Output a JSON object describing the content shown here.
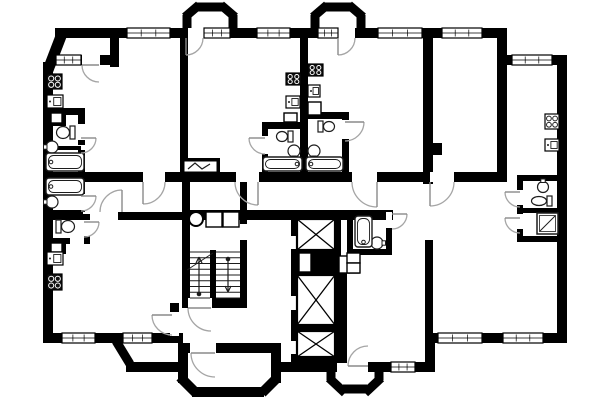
{
  "app": {
    "type": "architectural-floor-plan",
    "canvas_w": 600,
    "canvas_h": 400,
    "colors": {
      "wall": "#000000",
      "bg": "#ffffff",
      "fixture": "#1c1c1c",
      "arc": "#a5a5a5",
      "leaf": "#8a8a8a"
    }
  },
  "plan": {
    "chamfers": [
      [
        48,
        70,
        63,
        31,
        11,
        "corner-chamfer"
      ],
      [
        116,
        341,
        130,
        364,
        9,
        "porch-chamfer"
      ],
      [
        180,
        377,
        196,
        393,
        10,
        "bay-chamfer"
      ],
      [
        262,
        393,
        277,
        378,
        10,
        "bay-chamfer"
      ],
      [
        331,
        367,
        331,
        380,
        9,
        "bay-side"
      ],
      [
        329,
        378,
        345,
        393,
        9,
        "bay-chamfer"
      ],
      [
        343,
        389,
        367,
        389,
        9,
        "bay-bottom"
      ],
      [
        365,
        393,
        381,
        378,
        9,
        "bay-chamfer"
      ],
      [
        379,
        367,
        379,
        380,
        9,
        "bay-side"
      ],
      [
        187,
        30,
        187,
        15,
        9,
        "bay-side"
      ],
      [
        185,
        17,
        199,
        5,
        9,
        "bay-chamfer"
      ],
      [
        195,
        7,
        225,
        7,
        9,
        "bay-top"
      ],
      [
        221,
        5,
        235,
        17,
        9,
        "bay-chamfer"
      ],
      [
        233,
        15,
        233,
        30,
        9,
        "bay-side"
      ],
      [
        315,
        30,
        315,
        15,
        9,
        "bay-side"
      ],
      [
        313,
        17,
        327,
        5,
        9,
        "bay-chamfer"
      ],
      [
        323,
        7,
        353,
        7,
        9,
        "bay-top"
      ],
      [
        349,
        5,
        363,
        17,
        9,
        "bay-chamfer"
      ],
      [
        361,
        15,
        361,
        30,
        9,
        "bay-side"
      ]
    ],
    "walls": [
      [
        55,
        28,
        448,
        10
      ],
      [
        43,
        62,
        10,
        281
      ],
      [
        43,
        333,
        140,
        10
      ],
      [
        126,
        362,
        57,
        10
      ],
      [
        182,
        343,
        89,
        10
      ],
      [
        178,
        343,
        10,
        40
      ],
      [
        271,
        343,
        10,
        40
      ],
      [
        192,
        387,
        72,
        10
      ],
      [
        279,
        362,
        58,
        10
      ],
      [
        368,
        362,
        62,
        10
      ],
      [
        425,
        343,
        10,
        29
      ],
      [
        425,
        333,
        142,
        10
      ],
      [
        557,
        55,
        10,
        288
      ],
      [
        503,
        55,
        64,
        10
      ],
      [
        497,
        28,
        10,
        154
      ],
      [
        110,
        28,
        9,
        39
      ],
      [
        53,
        55,
        57,
        10
      ],
      [
        180,
        38,
        8,
        136
      ],
      [
        300,
        38,
        8,
        134
      ],
      [
        423,
        38,
        10,
        146
      ],
      [
        423,
        143,
        19,
        12
      ],
      [
        53,
        172,
        450,
        10
      ],
      [
        118,
        212,
        66,
        8
      ],
      [
        247,
        210,
        146,
        10
      ],
      [
        182,
        182,
        8,
        126
      ],
      [
        240,
        182,
        7,
        126
      ],
      [
        182,
        210,
        65,
        10
      ],
      [
        182,
        298,
        65,
        10
      ],
      [
        170,
        303,
        9,
        40
      ],
      [
        43,
        108,
        42,
        7
      ],
      [
        78,
        108,
        7,
        37
      ],
      [
        43,
        146,
        38,
        4
      ],
      [
        78,
        150,
        7,
        26
      ],
      [
        78,
        182,
        7,
        30
      ],
      [
        43,
        210,
        40,
        4
      ],
      [
        43,
        214,
        47,
        6
      ],
      [
        84,
        214,
        6,
        30
      ],
      [
        43,
        238,
        27,
        6
      ],
      [
        262,
        122,
        40,
        7
      ],
      [
        262,
        122,
        6,
        52
      ],
      [
        306,
        112,
        43,
        7
      ],
      [
        342,
        112,
        7,
        62
      ],
      [
        291,
        213,
        50,
        6
      ],
      [
        291,
        213,
        6,
        150
      ],
      [
        335,
        213,
        6,
        150
      ],
      [
        291,
        357,
        50,
        6
      ],
      [
        297,
        325,
        38,
        6
      ],
      [
        297,
        250,
        38,
        25
      ],
      [
        341,
        273,
        6,
        90
      ],
      [
        347,
        210,
        6,
        45
      ],
      [
        347,
        249,
        45,
        6
      ],
      [
        386,
        210,
        6,
        45
      ],
      [
        425,
        240,
        8,
        103
      ],
      [
        517,
        175,
        46,
        6
      ],
      [
        517,
        175,
        6,
        67
      ],
      [
        517,
        208,
        46,
        5
      ],
      [
        517,
        236,
        46,
        6
      ],
      [
        180,
        158,
        40,
        16
      ],
      [
        210,
        250,
        6,
        48
      ]
    ],
    "gaps": [
      [
        188,
        28,
        16,
        10
      ],
      [
        338,
        28,
        17,
        10
      ],
      [
        82,
        55,
        18,
        10
      ],
      [
        143,
        172,
        22,
        10
      ],
      [
        236,
        172,
        23,
        10
      ],
      [
        352,
        172,
        25,
        10
      ],
      [
        430,
        172,
        24,
        10
      ],
      [
        78,
        124,
        7,
        16
      ],
      [
        78,
        194,
        7,
        16
      ],
      [
        84,
        220,
        6,
        16
      ],
      [
        262,
        136,
        6,
        18
      ],
      [
        342,
        120,
        7,
        19
      ],
      [
        188,
        298,
        24,
        10
      ],
      [
        190,
        343,
        26,
        10
      ],
      [
        170,
        312,
        9,
        24
      ],
      [
        386,
        212,
        6,
        16
      ],
      [
        517,
        190,
        6,
        15
      ],
      [
        517,
        214,
        6,
        15
      ],
      [
        291,
        236,
        6,
        13
      ],
      [
        291,
        296,
        6,
        14
      ],
      [
        291,
        341,
        6,
        13
      ],
      [
        240,
        224,
        7,
        16
      ]
    ],
    "windows": [
      [
        127,
        28,
        43,
        10
      ],
      [
        204,
        28,
        26,
        10
      ],
      [
        257,
        28,
        33,
        10
      ],
      [
        318,
        28,
        20,
        10
      ],
      [
        378,
        28,
        44,
        10
      ],
      [
        442,
        28,
        40,
        10
      ],
      [
        512,
        55,
        40,
        10
      ],
      [
        56,
        55,
        25,
        10
      ],
      [
        62,
        333,
        33,
        10
      ],
      [
        123,
        333,
        29,
        10
      ],
      [
        391,
        362,
        24,
        10
      ],
      [
        438,
        333,
        44,
        10
      ],
      [
        503,
        333,
        40,
        10
      ]
    ],
    "doors": [
      {
        "h": [
          186,
          38
        ],
        "s": [
          186,
          55
        ],
        "e": [
          203,
          38
        ],
        "w": 0
      },
      {
        "h": [
          338,
          38
        ],
        "s": [
          338,
          55
        ],
        "e": [
          355,
          38
        ],
        "w": 0
      },
      {
        "h": [
          99,
          65
        ],
        "s": [
          82,
          65
        ],
        "e": [
          99,
          82
        ],
        "w": 0
      },
      {
        "h": [
          143,
          182
        ],
        "s": [
          143,
          204
        ],
        "e": [
          165,
          182
        ],
        "w": 0
      },
      {
        "h": [
          258,
          182
        ],
        "s": [
          258,
          205
        ],
        "e": [
          235,
          182
        ],
        "w": 1
      },
      {
        "h": [
          377,
          182
        ],
        "s": [
          377,
          207
        ],
        "e": [
          352,
          182
        ],
        "w": 1
      },
      {
        "h": [
          430,
          182
        ],
        "s": [
          430,
          206
        ],
        "e": [
          454,
          182
        ],
        "w": 0
      },
      {
        "h": [
          122,
          212
        ],
        "s": [
          122,
          190
        ],
        "e": [
          100,
          212
        ],
        "w": 0
      },
      {
        "h": [
          81,
          138
        ],
        "s": [
          96,
          138
        ],
        "e": [
          81,
          153
        ],
        "w": 1
      },
      {
        "h": [
          81,
          196
        ],
        "s": [
          96,
          196
        ],
        "e": [
          81,
          211
        ],
        "w": 1
      },
      {
        "h": [
          84,
          222
        ],
        "s": [
          99,
          222
        ],
        "e": [
          84,
          237
        ],
        "w": 1
      },
      {
        "h": [
          265,
          138
        ],
        "s": [
          249,
          138
        ],
        "e": [
          265,
          154
        ],
        "w": 0
      },
      {
        "h": [
          345,
          122
        ],
        "s": [
          364,
          122
        ],
        "e": [
          345,
          141
        ],
        "w": 1
      },
      {
        "h": [
          211,
          308
        ],
        "s": [
          188,
          308
        ],
        "e": [
          211,
          331
        ],
        "w": 0
      },
      {
        "h": [
          215,
          353
        ],
        "s": [
          191,
          353
        ],
        "e": [
          215,
          377
        ],
        "w": 0
      },
      {
        "h": [
          172,
          315
        ],
        "s": [
          152,
          315
        ],
        "e": [
          172,
          335
        ],
        "w": 0
      },
      {
        "h": [
          368,
          366
        ],
        "s": [
          348,
          366
        ],
        "e": [
          368,
          346
        ],
        "w": 1
      },
      {
        "h": [
          392,
          214
        ],
        "s": [
          407,
          214
        ],
        "e": [
          392,
          229
        ],
        "w": 1
      },
      {
        "h": [
          520,
          192
        ],
        "s": [
          505,
          192
        ],
        "e": [
          520,
          207
        ],
        "w": 0
      },
      {
        "h": [
          520,
          218
        ],
        "s": [
          505,
          218
        ],
        "e": [
          520,
          233
        ],
        "w": 0
      }
    ],
    "black_boxes": [
      [
        48,
        110,
        18,
        16
      ],
      [
        48,
        240,
        18,
        14
      ]
    ],
    "boxes": [
      [
        51,
        113,
        11,
        10
      ],
      [
        51,
        243,
        11,
        9
      ],
      [
        206,
        212,
        16,
        15
      ],
      [
        223,
        212,
        16,
        15
      ],
      [
        299,
        253,
        12,
        19
      ],
      [
        339,
        256,
        10,
        17
      ],
      [
        349,
        256,
        10,
        17
      ],
      [
        347,
        253,
        13,
        10
      ],
      [
        347,
        263,
        13,
        10
      ],
      [
        284,
        113,
        13,
        9
      ],
      [
        308,
        102,
        13,
        13
      ]
    ],
    "xboxes": [
      [
        297,
        219,
        38,
        31
      ],
      [
        297,
        275,
        38,
        50
      ],
      [
        297,
        331,
        38,
        26
      ]
    ],
    "circles": [
      {
        "c": [
          196,
          219
        ],
        "r": 7,
        "name": "garbage-chute"
      }
    ],
    "stoves": [
      {
        "r": [
          47,
          74,
          15,
          15
        ],
        "dark": true
      },
      {
        "r": [
          47,
          274,
          15,
          16
        ],
        "dark": true
      },
      {
        "r": [
          286,
          73,
          15,
          12
        ],
        "dark": true
      },
      {
        "r": [
          308,
          64,
          15,
          12
        ],
        "dark": true
      },
      {
        "r": [
          545,
          114,
          14,
          15
        ],
        "dark": false
      }
    ],
    "sinks": [
      [
        47,
        95,
        16,
        13
      ],
      [
        47,
        252,
        16,
        13
      ],
      [
        286,
        96,
        14,
        12
      ],
      [
        308,
        85,
        12,
        12
      ],
      [
        545,
        139,
        14,
        12
      ]
    ],
    "toilets": [
      {
        "r": [
          56,
          125,
          19,
          15
        ],
        "d": "left"
      },
      {
        "r": [
          56,
          219,
          19,
          15
        ],
        "d": "right"
      },
      {
        "r": [
          276,
          130,
          17,
          13
        ],
        "d": "left"
      },
      {
        "r": [
          318,
          120,
          17,
          13
        ],
        "d": "right"
      },
      {
        "r": [
          531,
          195,
          21,
          12
        ],
        "d": "left"
      }
    ],
    "basins": [
      {
        "c": [
          52,
          147
        ],
        "r": 6,
        "d": "left"
      },
      {
        "c": [
          52,
          202
        ],
        "r": 6,
        "d": "left"
      },
      {
        "c": [
          294,
          151
        ],
        "r": 6,
        "d": "down"
      },
      {
        "c": [
          314,
          151
        ],
        "r": 6,
        "d": "down"
      },
      {
        "c": [
          377,
          243
        ],
        "r": 6,
        "d": "right"
      },
      {
        "c": [
          543,
          187
        ],
        "r": 5.5,
        "d": "up"
      }
    ],
    "tubs": [
      {
        "r": [
          46,
          153,
          38,
          18
        ],
        "f": "left"
      },
      {
        "r": [
          46,
          178,
          38,
          17
        ],
        "f": "left"
      },
      {
        "r": [
          263,
          157,
          39,
          14
        ],
        "f": "right"
      },
      {
        "r": [
          306,
          157,
          37,
          14
        ],
        "f": "left"
      },
      {
        "r": [
          355,
          216,
          17,
          31
        ],
        "f": "bottom"
      }
    ],
    "showers": [
      [
        537,
        213,
        21,
        21
      ]
    ],
    "stairs": {
      "left_flight": [
        190,
        210
      ],
      "right_flight": [
        216,
        240
      ],
      "ytop": 252,
      "ybot": 298,
      "steps": 9,
      "up_arrow": {
        "x": 199,
        "from": 294,
        "to": 257
      },
      "down_arrow": {
        "x": 228,
        "from": 259,
        "to": 292
      },
      "diag": [
        187,
        270,
        213,
        253
      ]
    },
    "epanel": {
      "base": [
        180,
        158,
        40,
        16
      ],
      "panel": [
        184,
        161,
        33,
        11
      ],
      "zig": [
        [
          188,
          169
        ],
        [
          195,
          163
        ],
        [
          202,
          169
        ],
        [
          210,
          164
        ]
      ]
    }
  }
}
